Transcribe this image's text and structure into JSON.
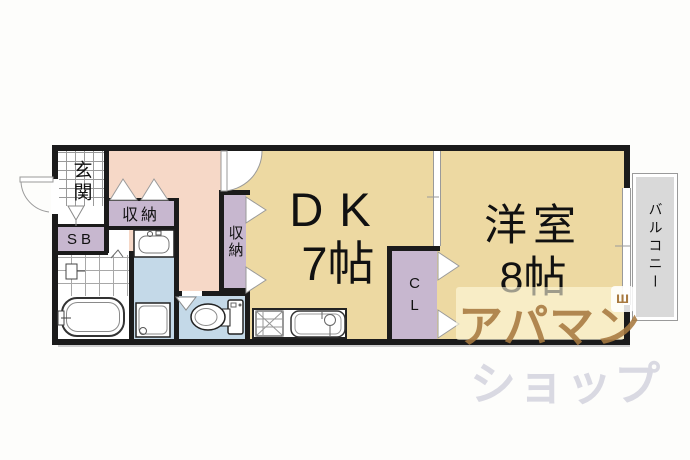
{
  "plan": {
    "rooms": {
      "entrance": {
        "label": "玄関"
      },
      "shoe_box": {
        "label": "SB"
      },
      "hall_storage": {
        "label": "収納"
      },
      "dk_storage": {
        "label": "収納"
      },
      "dining_kitchen": {
        "name": "DK",
        "area": "7帖"
      },
      "closet": {
        "label": "CL"
      },
      "western_room": {
        "name": "洋室",
        "area": "8帖"
      },
      "balcony": {
        "label": "バルコニー"
      }
    },
    "watermark": {
      "line1": "アパマン",
      "line2": "ショップ",
      "mark": "ш"
    },
    "colors": {
      "wall": "#1b1b1b",
      "room_floor": "#edd9a2",
      "hallway": "#f6d8c7",
      "storage": "#c7b7cf",
      "wet_area": "#c4d9e8",
      "balcony": "#d9d9d9",
      "watermark_front": "#a87a40",
      "watermark_back": "#d9d9e2"
    }
  }
}
